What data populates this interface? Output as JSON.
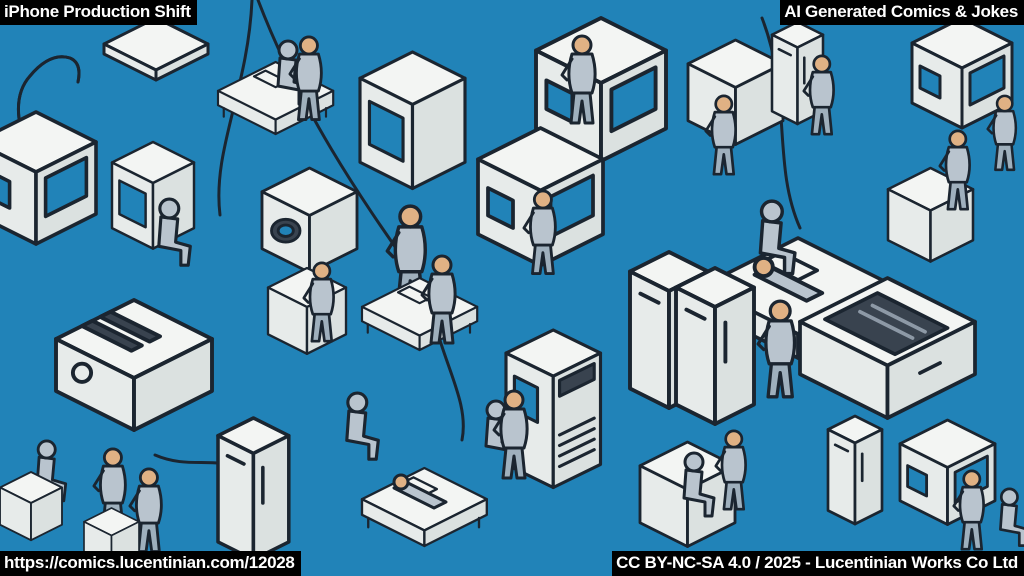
{
  "page_title": "iPhone Production Shift",
  "overlays": {
    "top_left": "iPhone Production Shift",
    "top_right": "AI Generated Comics & Jokes",
    "bottom_left": "https://comics.lucentinian.com/12028",
    "bottom_right": "CC BY-NC-SA 4.0 / 2025 - Lucentinian Works Co Ltd"
  },
  "artwork": {
    "alt": "Isometric line-art comic of an iPhone factory floor: dozens of white assembly machines, cabinets, beds and workstations with sketchy blue-grey workers on a flat blue background",
    "style": "isometric comic line-art",
    "colors": {
      "background": "#2183b8",
      "machine_face": "#f3f5f3",
      "machine_side": "#e7ebea",
      "machine_side2": "#dbe1e0",
      "outline": "#1b2530",
      "figure": "#b9c4ce",
      "figure_shade": "#9fb0bd",
      "skin": "#e0b184",
      "screen_dark": "#39434f"
    },
    "objects": [
      {
        "type": "j-tube",
        "x": 6,
        "y": 38,
        "s": 1
      },
      {
        "type": "panel",
        "x": 104,
        "y": 18,
        "s": 1
      },
      {
        "type": "machine-bed",
        "x": 218,
        "y": 62,
        "s": 0.72
      },
      {
        "type": "worker-sit",
        "x": 262,
        "y": 40,
        "s": 1
      },
      {
        "type": "worker-stand",
        "x": 288,
        "y": 36,
        "s": 0.95
      },
      {
        "type": "machine-monitor",
        "x": 360,
        "y": 52,
        "s": 1.05
      },
      {
        "type": "machine-window",
        "x": 536,
        "y": 18,
        "s": 1.3
      },
      {
        "type": "worker-stand",
        "x": 560,
        "y": 35,
        "s": 1
      },
      {
        "type": "machine-box",
        "x": 688,
        "y": 40,
        "s": 0.95
      },
      {
        "type": "worker-stand",
        "x": 704,
        "y": 95,
        "s": 0.9
      },
      {
        "type": "machine-tall",
        "x": 772,
        "y": 22,
        "s": 0.85
      },
      {
        "type": "worker-stand",
        "x": 802,
        "y": 55,
        "s": 0.9
      },
      {
        "type": "machine-window",
        "x": 912,
        "y": 18,
        "s": 1
      },
      {
        "type": "worker-stand",
        "x": 986,
        "y": 95,
        "s": 0.85
      },
      {
        "type": "machine-window",
        "x": -24,
        "y": 112,
        "s": 1.2
      },
      {
        "type": "machine-monitor",
        "x": 112,
        "y": 142,
        "s": 0.82
      },
      {
        "type": "worker-sit",
        "x": 142,
        "y": 198,
        "s": 1.05
      },
      {
        "type": "machine-oval",
        "x": 262,
        "y": 168,
        "s": 0.95
      },
      {
        "type": "worker-stand",
        "x": 385,
        "y": 205,
        "s": 1.15
      },
      {
        "type": "machine-window",
        "x": 478,
        "y": 128,
        "s": 1.25
      },
      {
        "type": "worker-stand",
        "x": 522,
        "y": 190,
        "s": 0.95
      },
      {
        "type": "machine-bed",
        "x": 702,
        "y": 238,
        "s": 1.2
      },
      {
        "type": "worker-sit",
        "x": 742,
        "y": 200,
        "s": 1.15
      },
      {
        "type": "worker-lying",
        "x": 752,
        "y": 254,
        "s": 1.3
      },
      {
        "type": "machine-box",
        "x": 888,
        "y": 168,
        "s": 0.85
      },
      {
        "type": "worker-stand",
        "x": 938,
        "y": 130,
        "s": 0.9
      },
      {
        "type": "machine-toaster",
        "x": 56,
        "y": 300,
        "s": 1.3
      },
      {
        "type": "machine-box",
        "x": 268,
        "y": 268,
        "s": 0.78
      },
      {
        "type": "worker-stand",
        "x": 302,
        "y": 262,
        "s": 0.9
      },
      {
        "type": "machine-bed",
        "x": 362,
        "y": 278,
        "s": 0.72
      },
      {
        "type": "worker-stand",
        "x": 420,
        "y": 255,
        "s": 1
      },
      {
        "type": "worker-sit",
        "x": 330,
        "y": 392,
        "s": 1.05
      },
      {
        "type": "machine-grille",
        "x": 506,
        "y": 330,
        "s": 1.05
      },
      {
        "type": "worker-sit",
        "x": 470,
        "y": 400,
        "s": 1
      },
      {
        "type": "machine-tall",
        "x": 630,
        "y": 252,
        "s": 1.3
      },
      {
        "type": "machine-tall",
        "x": 676,
        "y": 268,
        "s": 1.3
      },
      {
        "type": "worker-stand",
        "x": 756,
        "y": 300,
        "s": 1.1
      },
      {
        "type": "machine-screen-top",
        "x": 800,
        "y": 278,
        "s": 1.25
      },
      {
        "type": "worker-sit",
        "x": 22,
        "y": 440,
        "s": 0.95
      },
      {
        "type": "machine-box",
        "x": 0,
        "y": 472,
        "s": 0.62
      },
      {
        "type": "worker-stand",
        "x": 92,
        "y": 448,
        "s": 0.95
      },
      {
        "type": "worker-stand",
        "x": 128,
        "y": 468,
        "s": 0.95
      },
      {
        "type": "machine-box",
        "x": 84,
        "y": 508,
        "s": 0.55
      },
      {
        "type": "machine-tall",
        "x": 218,
        "y": 418,
        "s": 1.18
      },
      {
        "type": "machine-bed",
        "x": 362,
        "y": 468,
        "s": 0.78
      },
      {
        "type": "worker-lying",
        "x": 392,
        "y": 472,
        "s": 1
      },
      {
        "type": "worker-stand",
        "x": 492,
        "y": 390,
        "s": 1
      },
      {
        "type": "machine-box",
        "x": 640,
        "y": 442,
        "s": 0.95
      },
      {
        "type": "worker-sit",
        "x": 668,
        "y": 452,
        "s": 1
      },
      {
        "type": "worker-stand",
        "x": 714,
        "y": 430,
        "s": 0.9
      },
      {
        "type": "machine-tall",
        "x": 828,
        "y": 416,
        "s": 0.9
      },
      {
        "type": "machine-window",
        "x": 900,
        "y": 420,
        "s": 0.95
      },
      {
        "type": "worker-stand",
        "x": 952,
        "y": 470,
        "s": 0.9
      },
      {
        "type": "worker-sit",
        "x": 986,
        "y": 488,
        "s": 0.9
      }
    ]
  }
}
